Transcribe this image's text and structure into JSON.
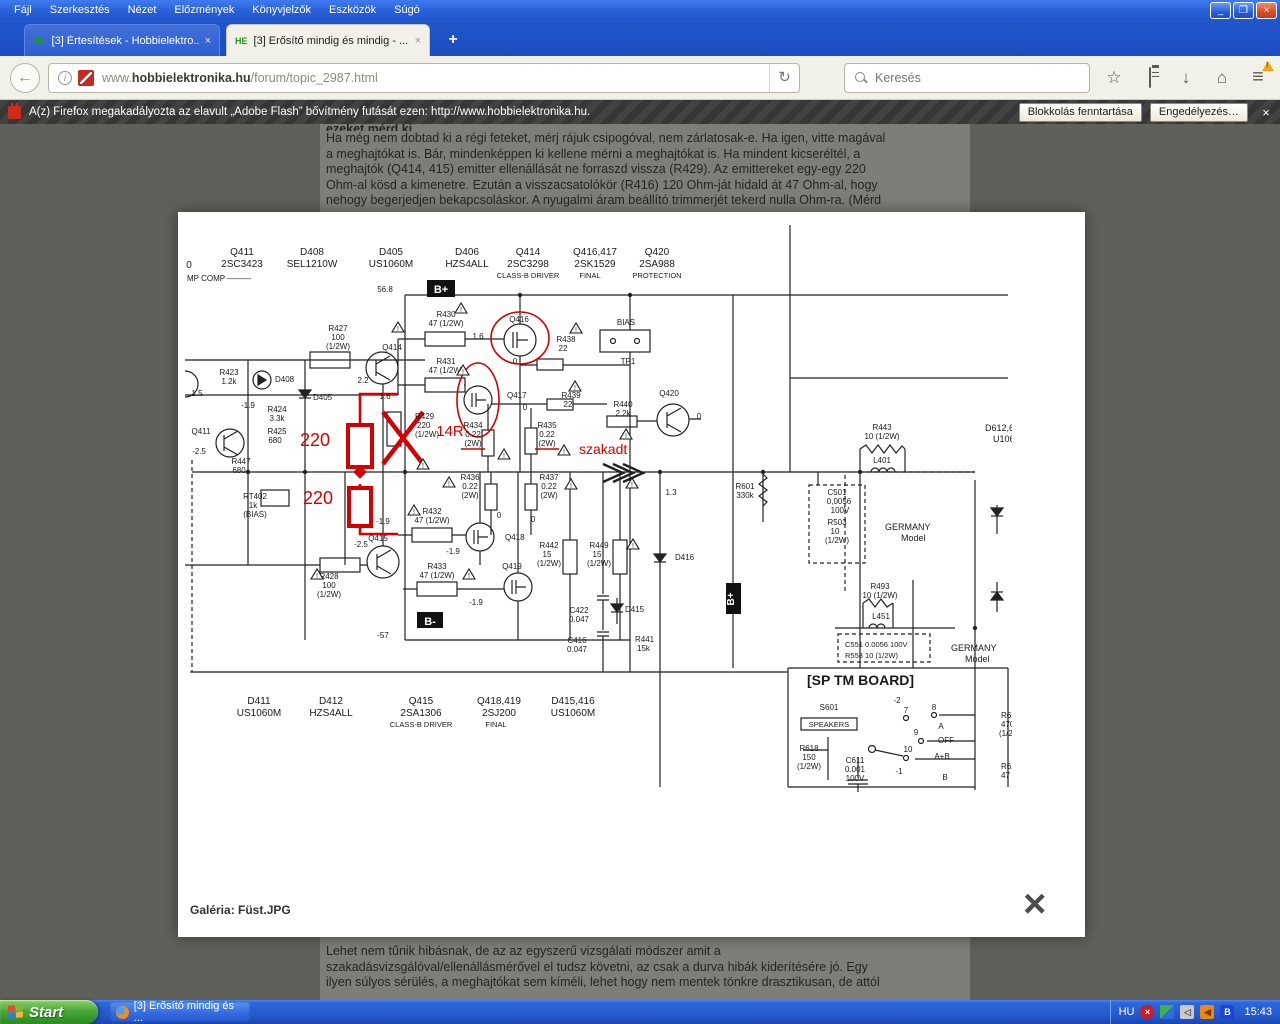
{
  "browser": {
    "menu": [
      "Fájl",
      "Szerkesztés",
      "Nézet",
      "Előzmények",
      "Könyvjelzők",
      "Eszközök",
      "Súgó"
    ],
    "tabs": [
      {
        "favicon": "HE",
        "title": "[3] Értesítések - Hobbielektro...",
        "close": "×"
      },
      {
        "favicon": "HE",
        "title": "[3] Erősítő mindig és mindig - ...",
        "close": "×"
      }
    ],
    "new_tab_label": "+",
    "back_glyph": "←",
    "reload_glyph": "↻",
    "url_prefix": "www.",
    "url_domain": "hobbielektronika.hu",
    "url_path": "/forum/topic_2987.html",
    "search_placeholder": "Keresés",
    "star_glyph": "☆",
    "download_glyph": "↓",
    "home_glyph": "⌂",
    "menu_glyph": "≡",
    "notification": {
      "text": "A(z) Firefox megakadályozta az elavult „Adobe Flash” bővítmény futását ezen: http://www.hobbielektronika.hu.",
      "keep_blocking": "Blokkolás fenntartása",
      "allow": "Engedélyezés…",
      "close": "×"
    }
  },
  "page": {
    "top_clipped_line": "ezeket mérd ki.",
    "top_lines": [
      "Ha még nem dobtad ki a régi feteket, mérj rájuk csipogóval, nem zárlatosak-e. Ha igen, vitte magával",
      "a meghajtókat is. Bár, mindenképpen ki kellene mérni a meghajtókat is. Ha mindent kicseréltél, a",
      "meghajtók (Q414, 415) emitter ellenállását ne forraszd vissza (R429). Az emittereket egy-egy 220",
      "Ohm-al kösd a kimenetre. Ezután a visszacsatolókör (R416) 120 Ohm-ját hidald át 47 Ohm-al, hogy",
      "nehogy begerjedjen bekapcsoláskor. A nyugalmi áram beállító trimmerjét tekerd nulla Ohm-ra. (Mérd"
    ],
    "bottom_lines": [
      "Lehet nem tűnik hibásnak, de az az egyszerű vizsgálati módszer amit a",
      "szakadásvizsgálóval/ellenállásmérővel el tudsz követni, az csak a durva hibák kiderítésére jó. Egy",
      "ilyen súlyos sérülés, a meghajtókat sem kíméli, lehet hogy nem mentek tönkre drasztikusan, de attól"
    ]
  },
  "lightbox": {
    "caption": "Galéria: Füst.JPG",
    "close_glyph": "×"
  },
  "schematic": {
    "red": "#d40000",
    "warning_glyph": "!",
    "labels": [
      {
        "t": "0",
        "x": 4,
        "y": 46,
        "s": 10
      },
      {
        "t": "Q411",
        "x": 57,
        "y": 33,
        "s": 10
      },
      {
        "t": "2SC3423",
        "x": 57,
        "y": 45,
        "s": 10
      },
      {
        "t": "MP COMP ———",
        "x": 2,
        "y": 59,
        "s": 8,
        "a": "start"
      },
      {
        "t": "D408",
        "x": 127,
        "y": 33,
        "s": 10
      },
      {
        "t": "SEL1210W",
        "x": 127,
        "y": 45,
        "s": 10
      },
      {
        "t": "D405",
        "x": 206,
        "y": 33,
        "s": 10
      },
      {
        "t": "US1060M",
        "x": 206,
        "y": 45,
        "s": 10
      },
      {
        "t": "D406",
        "x": 282,
        "y": 33,
        "s": 10
      },
      {
        "t": "HZS4ALL",
        "x": 282,
        "y": 45,
        "s": 10
      },
      {
        "t": "Q414",
        "x": 343,
        "y": 33,
        "s": 10
      },
      {
        "t": "2SC3298",
        "x": 343,
        "y": 45,
        "s": 10
      },
      {
        "t": "CLASS-B DRIVER",
        "x": 343,
        "y": 56,
        "s": 7.5
      },
      {
        "t": "Q416,417",
        "x": 410,
        "y": 33,
        "s": 10
      },
      {
        "t": "2SK1529",
        "x": 410,
        "y": 45,
        "s": 10
      },
      {
        "t": "FINAL",
        "x": 405,
        "y": 56,
        "s": 7.5
      },
      {
        "t": "Q420",
        "x": 472,
        "y": 33,
        "s": 10
      },
      {
        "t": "2SA988",
        "x": 472,
        "y": 45,
        "s": 10
      },
      {
        "t": "PROTECTION",
        "x": 472,
        "y": 56,
        "s": 7.5
      },
      {
        "t": "56.8",
        "x": 200,
        "y": 70,
        "s": 8
      },
      {
        "t": "B+",
        "x": 256,
        "y": 71,
        "c": "#fff",
        "b": 1,
        "s": 11
      },
      {
        "t": "R423",
        "x": 44,
        "y": 153,
        "s": 8
      },
      {
        "t": "1.2k",
        "x": 44,
        "y": 162,
        "s": 8
      },
      {
        "t": "1.5",
        "x": 12,
        "y": 174,
        "s": 8
      },
      {
        "t": "D408",
        "x": 90,
        "y": 160,
        "s": 8,
        "a": "start"
      },
      {
        "t": "D405",
        "x": 128,
        "y": 178,
        "s": 8,
        "a": "start"
      },
      {
        "t": "R424",
        "x": 92,
        "y": 190,
        "s": 8
      },
      {
        "t": "3.3k",
        "x": 92,
        "y": 199,
        "s": 8
      },
      {
        "t": "-1.9",
        "x": 63,
        "y": 186,
        "s": 8
      },
      {
        "t": "R425",
        "x": 92,
        "y": 212,
        "s": 8
      },
      {
        "t": "680",
        "x": 90,
        "y": 221,
        "s": 8
      },
      {
        "t": "Q411",
        "x": 16,
        "y": 212,
        "s": 8
      },
      {
        "t": "-2.5",
        "x": 14,
        "y": 232,
        "s": 8
      },
      {
        "t": "R447",
        "x": 56,
        "y": 242,
        "s": 8
      },
      {
        "t": "680",
        "x": 54,
        "y": 251,
        "s": 8
      },
      {
        "t": "RT402",
        "x": 70,
        "y": 277,
        "s": 8
      },
      {
        "t": "1k",
        "x": 68,
        "y": 286,
        "s": 8
      },
      {
        "t": "(BIAS)",
        "x": 70,
        "y": 295,
        "s": 8
      },
      {
        "t": "R427",
        "x": 153,
        "y": 109,
        "s": 8
      },
      {
        "t": "100",
        "x": 153,
        "y": 118,
        "s": 8
      },
      {
        "t": "(1/2W)",
        "x": 153,
        "y": 127,
        "s": 8
      },
      {
        "t": "Q414",
        "x": 207,
        "y": 128,
        "s": 8
      },
      {
        "t": "2.2",
        "x": 178,
        "y": 161,
        "s": 8
      },
      {
        "t": "R430",
        "x": 261,
        "y": 95,
        "s": 8
      },
      {
        "t": "47 (1/2W)",
        "x": 261,
        "y": 104,
        "s": 8
      },
      {
        "t": "1.6",
        "x": 293,
        "y": 117,
        "s": 8
      },
      {
        "t": "Q416",
        "x": 334,
        "y": 100,
        "s": 8
      },
      {
        "t": "R438",
        "x": 381,
        "y": 120,
        "s": 8
      },
      {
        "t": "22",
        "x": 378,
        "y": 129,
        "s": 8
      },
      {
        "t": "R431",
        "x": 261,
        "y": 142,
        "s": 8
      },
      {
        "t": "47 (1/2W)",
        "x": 261,
        "y": 151,
        "s": 8
      },
      {
        "t": "1.6",
        "x": 200,
        "y": 177,
        "s": 8
      },
      {
        "t": "Q417",
        "x": 322,
        "y": 176,
        "s": 8,
        "a": "start"
      },
      {
        "t": "0",
        "x": 330,
        "y": 142,
        "s": 8
      },
      {
        "t": "0",
        "x": 340,
        "y": 188,
        "s": 8
      },
      {
        "t": "R439",
        "x": 386,
        "y": 176,
        "s": 8
      },
      {
        "t": "22",
        "x": 383,
        "y": 185,
        "s": 8
      },
      {
        "t": "R440",
        "x": 438,
        "y": 185,
        "s": 8
      },
      {
        "t": "2.2k",
        "x": 438,
        "y": 194,
        "s": 8
      },
      {
        "t": "BIAS",
        "x": 441,
        "y": 103,
        "s": 8
      },
      {
        "t": "TP1",
        "x": 443,
        "y": 142,
        "s": 8
      },
      {
        "t": "Q420",
        "x": 484,
        "y": 174,
        "s": 8
      },
      {
        "t": "0",
        "x": 514,
        "y": 197,
        "s": 8
      },
      {
        "t": "R429",
        "x": 230,
        "y": 197,
        "s": 8,
        "a": "start"
      },
      {
        "t": "220",
        "x": 232,
        "y": 206,
        "s": 8,
        "a": "start"
      },
      {
        "t": "(1/2W)",
        "x": 230,
        "y": 215,
        "s": 8,
        "a": "start"
      },
      {
        "t": "220",
        "x": 130,
        "y": 224,
        "c": "#d40000",
        "s": 18
      },
      {
        "t": "14R",
        "x": 265,
        "y": 214,
        "c": "#d40000",
        "s": 15
      },
      {
        "t": "R434",
        "x": 288,
        "y": 206,
        "s": 8
      },
      {
        "t": "0.22",
        "x": 288,
        "y": 215,
        "s": 8
      },
      {
        "t": "(2W)",
        "x": 288,
        "y": 224,
        "s": 8
      },
      {
        "t": "R435",
        "x": 362,
        "y": 206,
        "s": 8
      },
      {
        "t": "0.22",
        "x": 362,
        "y": 215,
        "s": 8
      },
      {
        "t": "(2W)",
        "x": 362,
        "y": 224,
        "s": 8
      },
      {
        "t": "szakadt",
        "x": 394,
        "y": 232,
        "c": "#d40000",
        "s": 14,
        "a": "start"
      },
      {
        "t": "R436",
        "x": 285,
        "y": 258,
        "s": 8
      },
      {
        "t": "0.22",
        "x": 285,
        "y": 267,
        "s": 8
      },
      {
        "t": "(2W)",
        "x": 285,
        "y": 276,
        "s": 8
      },
      {
        "t": "R437",
        "x": 364,
        "y": 258,
        "s": 8
      },
      {
        "t": "0.22",
        "x": 364,
        "y": 267,
        "s": 8
      },
      {
        "t": "(2W)",
        "x": 364,
        "y": 276,
        "s": 8
      },
      {
        "t": "220",
        "x": 133,
        "y": 282,
        "c": "#d40000",
        "s": 18
      },
      {
        "t": "-1.9",
        "x": 198,
        "y": 302,
        "s": 8
      },
      {
        "t": "Q415",
        "x": 193,
        "y": 319,
        "s": 8
      },
      {
        "t": "-2.5",
        "x": 176,
        "y": 325,
        "s": 8
      },
      {
        "t": "R432",
        "x": 247,
        "y": 292,
        "s": 8
      },
      {
        "t": "47 (1/2W)",
        "x": 247,
        "y": 301,
        "s": 8
      },
      {
        "t": "Q418",
        "x": 320,
        "y": 318,
        "s": 8,
        "a": "start"
      },
      {
        "t": "-1.9",
        "x": 268,
        "y": 332,
        "s": 8
      },
      {
        "t": "0",
        "x": 314,
        "y": 296,
        "s": 8
      },
      {
        "t": "0",
        "x": 348,
        "y": 300,
        "s": 8
      },
      {
        "t": "R433",
        "x": 252,
        "y": 347,
        "s": 8
      },
      {
        "t": "47 (1/2W)",
        "x": 252,
        "y": 356,
        "s": 8
      },
      {
        "t": "Q419",
        "x": 327,
        "y": 347,
        "s": 8
      },
      {
        "t": "-1.9",
        "x": 291,
        "y": 383,
        "s": 8
      },
      {
        "t": "R428",
        "x": 144,
        "y": 357,
        "s": 8
      },
      {
        "t": "100",
        "x": 144,
        "y": 366,
        "s": 8
      },
      {
        "t": "(1/2W)",
        "x": 144,
        "y": 375,
        "s": 8
      },
      {
        "t": "R442",
        "x": 364,
        "y": 326,
        "s": 8
      },
      {
        "t": "15",
        "x": 362,
        "y": 335,
        "s": 8
      },
      {
        "t": "(1/2W)",
        "x": 364,
        "y": 344,
        "s": 8
      },
      {
        "t": "R449",
        "x": 414,
        "y": 326,
        "s": 8
      },
      {
        "t": "15",
        "x": 412,
        "y": 335,
        "s": 8
      },
      {
        "t": "(1/2W)",
        "x": 414,
        "y": 344,
        "s": 8
      },
      {
        "t": "C422",
        "x": 394,
        "y": 391,
        "s": 8
      },
      {
        "t": "0.047",
        "x": 394,
        "y": 400,
        "s": 8
      },
      {
        "t": "C416",
        "x": 392,
        "y": 421,
        "s": 8
      },
      {
        "t": "0.047",
        "x": 392,
        "y": 430,
        "s": 8
      },
      {
        "t": "D415",
        "x": 440,
        "y": 390,
        "s": 8,
        "a": "start"
      },
      {
        "t": "R441",
        "x": 450,
        "y": 420,
        "s": 8,
        "a": "start"
      },
      {
        "t": "15k",
        "x": 452,
        "y": 429,
        "s": 8,
        "a": "start"
      },
      {
        "t": "D416",
        "x": 490,
        "y": 338,
        "s": 8,
        "a": "start"
      },
      {
        "t": "1.3",
        "x": 486,
        "y": 273,
        "s": 8
      },
      {
        "t": "B-",
        "x": 245,
        "y": 403,
        "c": "#fff",
        "b": 1,
        "s": 11
      },
      {
        "t": "-57",
        "x": 198,
        "y": 416,
        "s": 8
      },
      {
        "t": "R601",
        "x": 560,
        "y": 267,
        "s": 8
      },
      {
        "t": "330k",
        "x": 560,
        "y": 276,
        "s": 8
      },
      {
        "t": "B+",
        "x": 549,
        "y": 377,
        "c": "#fff",
        "b": 1,
        "s": 10,
        "r": -90
      },
      {
        "t": "R443",
        "x": 697,
        "y": 208,
        "s": 8
      },
      {
        "t": "10 (1/2W)",
        "x": 697,
        "y": 217,
        "s": 8
      },
      {
        "t": "L401",
        "x": 697,
        "y": 241,
        "s": 8
      },
      {
        "t": "D612,6",
        "x": 800,
        "y": 209,
        "s": 9,
        "a": "start"
      },
      {
        "t": "U1060",
        "x": 808,
        "y": 220,
        "s": 9,
        "a": "start"
      },
      {
        "t": "C501",
        "x": 652,
        "y": 273,
        "s": 8
      },
      {
        "t": "0,0056",
        "x": 654,
        "y": 282,
        "s": 8
      },
      {
        "t": "100V",
        "x": 655,
        "y": 291,
        "s": 8
      },
      {
        "t": "R503",
        "x": 652,
        "y": 303,
        "s": 8
      },
      {
        "t": "10",
        "x": 650,
        "y": 312,
        "s": 8
      },
      {
        "t": "(1/2W)",
        "x": 652,
        "y": 321,
        "s": 8
      },
      {
        "t": "GERMANY",
        "x": 700,
        "y": 308,
        "s": 9,
        "a": "start"
      },
      {
        "t": "Model",
        "x": 716,
        "y": 319,
        "s": 9,
        "a": "start"
      },
      {
        "t": "R493",
        "x": 695,
        "y": 367,
        "s": 8
      },
      {
        "t": "10 (1/2W)",
        "x": 695,
        "y": 376,
        "s": 8
      },
      {
        "t": "L451",
        "x": 696,
        "y": 397,
        "s": 8
      },
      {
        "t": "C551 0.0056 100V",
        "x": 660,
        "y": 425,
        "s": 7.5,
        "a": "start"
      },
      {
        "t": "R553 10 (1/2W)",
        "x": 660,
        "y": 436,
        "s": 7.5,
        "a": "start"
      },
      {
        "t": "GERMANY",
        "x": 766,
        "y": 429,
        "s": 9,
        "a": "start"
      },
      {
        "t": "Model",
        "x": 780,
        "y": 440,
        "s": 9,
        "a": "start"
      },
      {
        "t": "[SP TM BOARD]",
        "x": 622,
        "y": 463,
        "s": 14,
        "b": 1,
        "a": "start"
      },
      {
        "t": "S601",
        "x": 644,
        "y": 488,
        "s": 8
      },
      {
        "t": "SPEAKERS",
        "x": 644,
        "y": 505,
        "s": 7.5
      },
      {
        "t": "-2",
        "x": 712,
        "y": 481,
        "s": 8
      },
      {
        "t": "7",
        "x": 721,
        "y": 491,
        "s": 8
      },
      {
        "t": "8",
        "x": 749,
        "y": 488,
        "s": 8
      },
      {
        "t": "A",
        "x": 756,
        "y": 507,
        "s": 8
      },
      {
        "t": "9",
        "x": 731,
        "y": 513,
        "s": 8
      },
      {
        "t": "OFF",
        "x": 761,
        "y": 521,
        "s": 8
      },
      {
        "t": "10",
        "x": 723,
        "y": 530,
        "s": 8
      },
      {
        "t": "A+B",
        "x": 757,
        "y": 537,
        "s": 8
      },
      {
        "t": "-1",
        "x": 714,
        "y": 552,
        "s": 8
      },
      {
        "t": "B",
        "x": 760,
        "y": 558,
        "s": 8
      },
      {
        "t": "R618",
        "x": 624,
        "y": 529,
        "s": 8
      },
      {
        "t": "150",
        "x": 624,
        "y": 538,
        "s": 8
      },
      {
        "t": "(1/2W)",
        "x": 624,
        "y": 547,
        "s": 8
      },
      {
        "t": "C611",
        "x": 670,
        "y": 541,
        "s": 8
      },
      {
        "t": "0.001",
        "x": 670,
        "y": 550,
        "s": 8
      },
      {
        "t": "100V",
        "x": 670,
        "y": 559,
        "s": 8
      },
      {
        "t": "R62",
        "x": 816,
        "y": 496,
        "s": 8,
        "a": "start"
      },
      {
        "t": "470",
        "x": 816,
        "y": 505,
        "s": 8,
        "a": "start"
      },
      {
        "t": "(1/2",
        "x": 814,
        "y": 514,
        "s": 8,
        "a": "start"
      },
      {
        "t": "R62",
        "x": 816,
        "y": 547,
        "s": 8,
        "a": "start"
      },
      {
        "t": "47",
        "x": 816,
        "y": 556,
        "s": 8,
        "a": "start"
      },
      {
        "t": "D411",
        "x": 74,
        "y": 482,
        "s": 10
      },
      {
        "t": "US1060M",
        "x": 74,
        "y": 494,
        "s": 10
      },
      {
        "t": "D412",
        "x": 146,
        "y": 482,
        "s": 10
      },
      {
        "t": "HZS4ALL",
        "x": 146,
        "y": 494,
        "s": 10
      },
      {
        "t": "Q415",
        "x": 236,
        "y": 482,
        "s": 10
      },
      {
        "t": "2SA1306",
        "x": 236,
        "y": 494,
        "s": 10
      },
      {
        "t": "CLASS-B DRIVER",
        "x": 236,
        "y": 505,
        "s": 7.5
      },
      {
        "t": "Q418,419",
        "x": 314,
        "y": 482,
        "s": 10
      },
      {
        "t": "2SJ200",
        "x": 314,
        "y": 494,
        "s": 10
      },
      {
        "t": "FINAL",
        "x": 311,
        "y": 505,
        "s": 7.5
      },
      {
        "t": "D415,416",
        "x": 388,
        "y": 482,
        "s": 10
      },
      {
        "t": "US1060M",
        "x": 388,
        "y": 494,
        "s": 10
      }
    ],
    "triangles": [
      [
        213,
        106
      ],
      [
        276,
        87
      ],
      [
        278,
        149
      ],
      [
        238,
        243
      ],
      [
        319,
        233
      ],
      [
        379,
        229
      ],
      [
        391,
        107
      ],
      [
        390,
        165
      ],
      [
        441,
        213
      ],
      [
        264,
        261
      ],
      [
        386,
        263
      ],
      [
        229,
        289
      ],
      [
        284,
        353
      ],
      [
        132,
        353
      ],
      [
        448,
        323
      ],
      [
        447,
        262
      ]
    ]
  },
  "taskbar": {
    "start": "Start",
    "task": "[3] Erősítő mindig és ...",
    "lang": "HU",
    "time": "15:43"
  }
}
